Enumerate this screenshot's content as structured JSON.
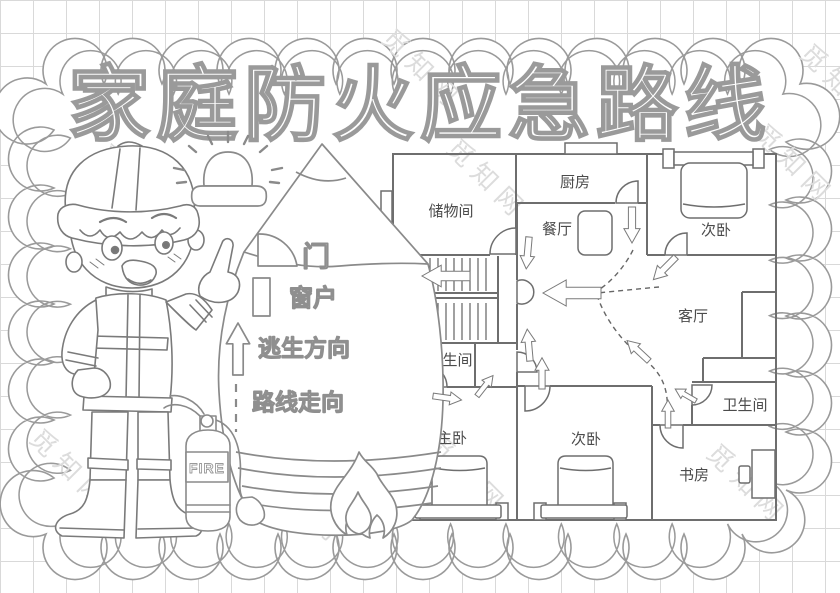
{
  "poster": {
    "title": "家庭防火应急路线",
    "watermark_text": "觅知网",
    "legend": {
      "door": "门",
      "window": "窗户",
      "escape": "逃生方向",
      "route": "路线走向"
    },
    "extinguisher_label": "FIRE",
    "plan": {
      "rooms": [
        {
          "name": "储物间"
        },
        {
          "name": "厨房"
        },
        {
          "name": "次卧"
        },
        {
          "name": "餐厅"
        },
        {
          "name": "客厅"
        },
        {
          "name": "卫生间"
        },
        {
          "name": "主卧"
        },
        {
          "name": "次卧"
        },
        {
          "name": "书房"
        },
        {
          "name": "卫生间"
        }
      ]
    },
    "colors": {
      "line": "#8a8a8a",
      "wall": "#6e6e6e",
      "label": "#4b4b4b",
      "watermark": "#dcdcdc"
    }
  }
}
